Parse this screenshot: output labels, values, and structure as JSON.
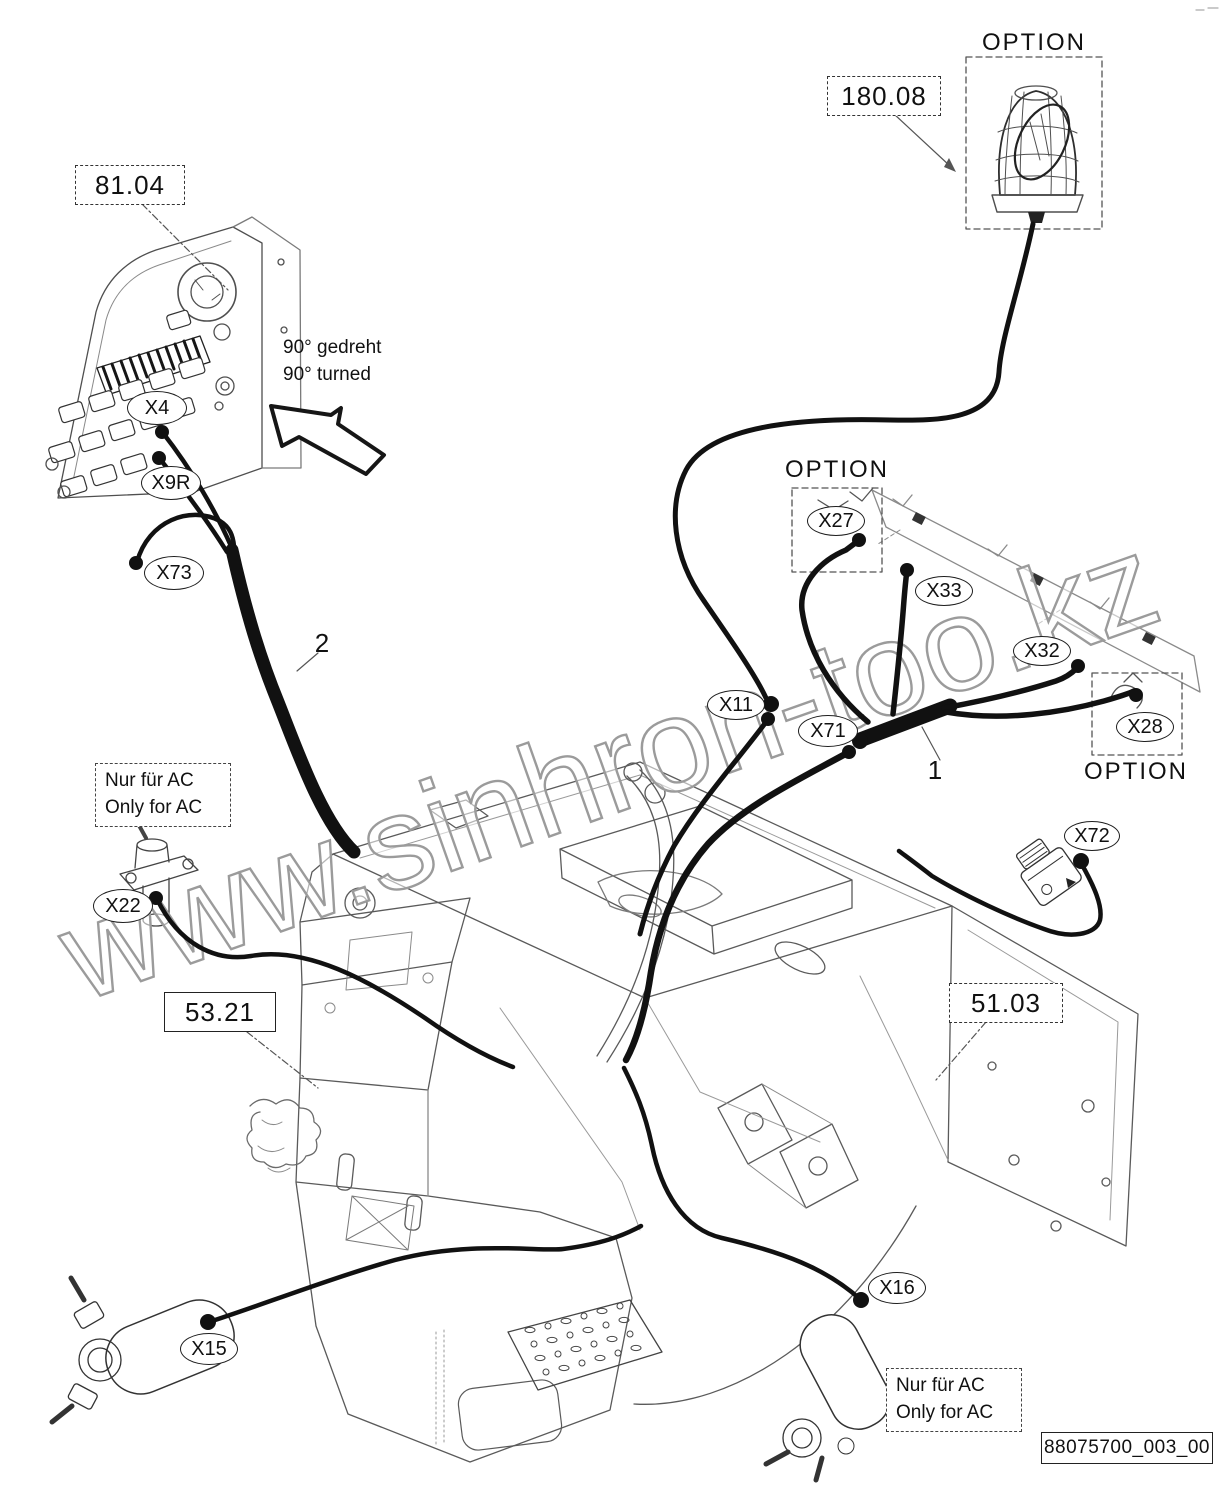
{
  "watermark": {
    "text": "www.sinhron-too.kz",
    "color": "#9b9b9b"
  },
  "drawing_number": "88075700_003_00",
  "part_refs": {
    "console": {
      "label": "81.04"
    },
    "beacon": {
      "label": "180.08"
    },
    "cab": {
      "label": "53.21"
    },
    "frame": {
      "label": "51.03"
    }
  },
  "option_labels": {
    "beacon": "OPTION",
    "roof_left": "OPTION",
    "roof_right": "OPTION"
  },
  "connectors": {
    "x4": "X4",
    "x9r": "X9R",
    "x73": "X73",
    "x22": "X22",
    "x15": "X15",
    "x16": "X16",
    "x11": "X11",
    "x71": "X71",
    "x27": "X27",
    "x33": "X33",
    "x32": "X32",
    "x28": "X28",
    "x72": "X72"
  },
  "callouts": {
    "harness_roof": "1",
    "harness_console": "2"
  },
  "notes": {
    "rotation": {
      "line1": "90° gedreht",
      "line2": "90° turned"
    },
    "ac_left": {
      "line1": "Nur für AC",
      "line2": "Only for AC"
    },
    "ac_right": {
      "line1": "Nur für AC",
      "line2": "Only for AC"
    }
  },
  "colors": {
    "ink": "#111111",
    "structure": "#5a5a5a",
    "watermark": "#9b9b9b"
  }
}
